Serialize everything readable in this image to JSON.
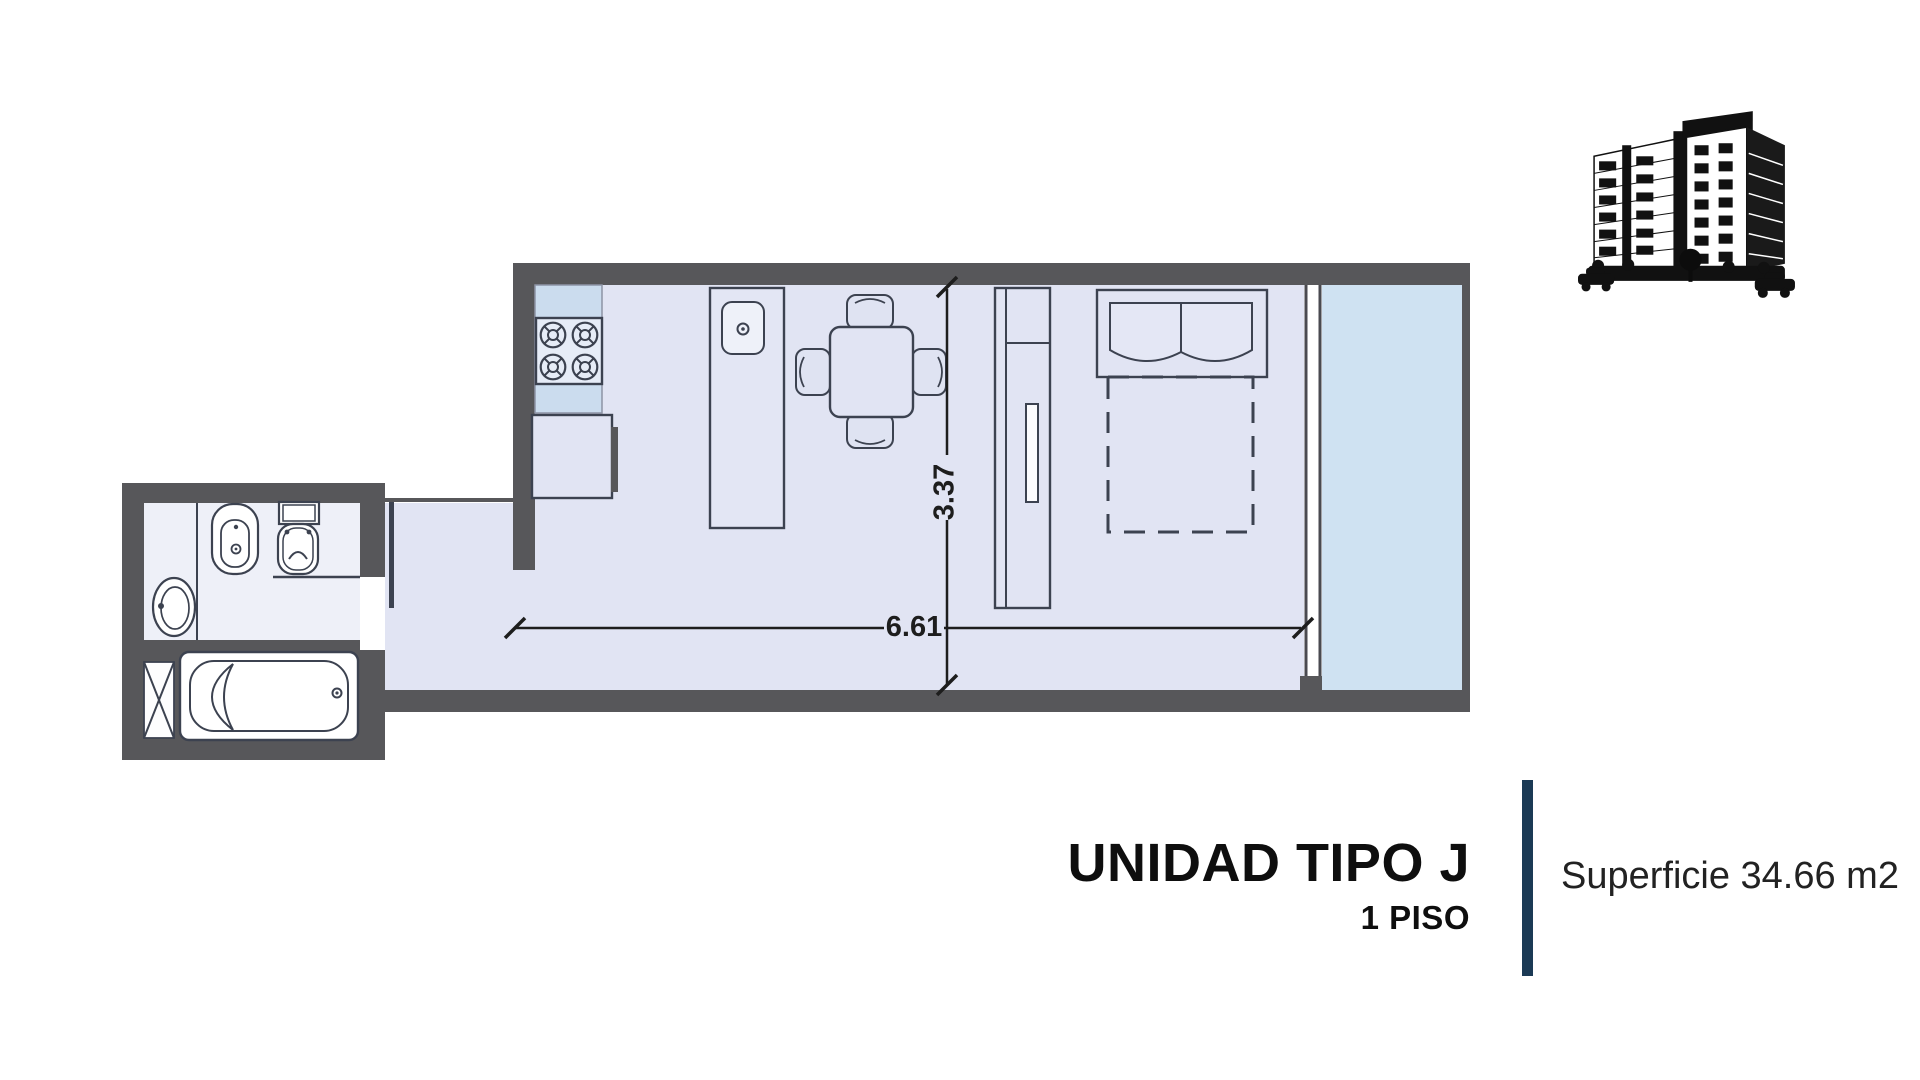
{
  "plan": {
    "dimensions": {
      "width": "6.61",
      "height": "3.37"
    },
    "colors": {
      "wall": "#57575a",
      "floor": "#e1e4f3",
      "balcony_floor": "#cfe2f2",
      "kitchen_counter": "#cbdcee",
      "bathroom_floor": "#eef0f8",
      "fixture_line": "#3c4250",
      "dimension_line": "#1d1d1d"
    },
    "fixtures": [
      "stove-icon",
      "refrigerator-icon",
      "island-sink-icon",
      "dining-table-icon",
      "chair-icon",
      "wardrobe-icon",
      "double-bed-icon",
      "pillow-icon",
      "balcony-glass-wall-icon",
      "bathtub-icon",
      "toilet-icon",
      "bidet-icon",
      "washbasin-icon",
      "duct-shaft-icon",
      "entry-door-icon"
    ]
  },
  "title_block": {
    "unit_title": "UNIDAD TIPO J",
    "floor_label": "1 PISO",
    "area_label": "Superficie 34.66 m2",
    "accent_color": "#1b3a55"
  },
  "branding": {
    "building_illustration": "apartment-building-sketch"
  }
}
